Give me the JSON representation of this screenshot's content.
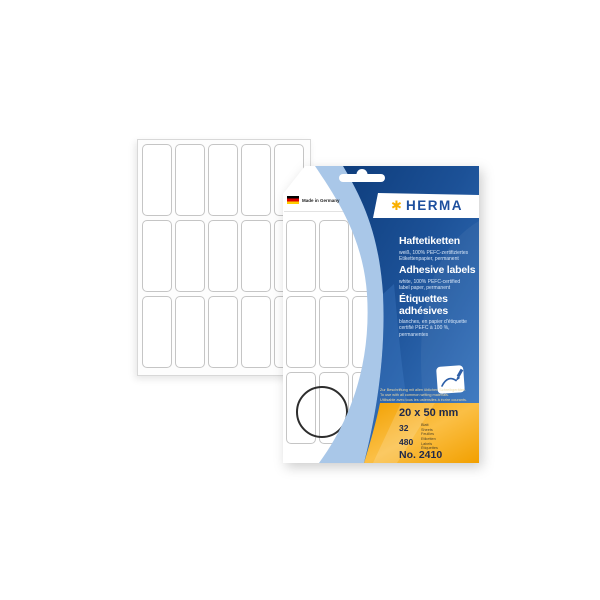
{
  "package": {
    "brand": "HERMA",
    "made_in": "Made in Germany",
    "icons": {
      "brand_star": "✱"
    },
    "titles": {
      "de": {
        "heading": "Haftetiketten",
        "sub1": "weiß, 100% PEFC-zertifiziertes",
        "sub2": "Etikettenpapier, permanent"
      },
      "en": {
        "heading": "Adhesive labels",
        "sub1": "white, 100% PEFC-certified",
        "sub2": "label paper, permanent"
      },
      "fr": {
        "heading1": "Étiquettes",
        "heading2": "adhésives",
        "sub1": "blanches, en papier d'étiquette",
        "sub2": "certifié PEFC à 100 %,",
        "sub3": "permanentes"
      }
    },
    "usage_note": {
      "de": "Zur Beschriftung mit allen üblichen Schreibgeräten.",
      "en": "To use with all common writing materials.",
      "fr": "Utilisable avec tous les ustensiles à écrire courants."
    },
    "specs": {
      "size": "20 x 50 mm",
      "sheets_count": "32",
      "sheets_units": [
        "Blatt",
        "Sheets",
        "Feuilles"
      ],
      "labels_count": "480",
      "labels_units": [
        "Etiketten",
        "Labels",
        "Étiquettes"
      ],
      "item_no": "No. 2410"
    },
    "colors": {
      "navy_dark": "#0e3d7c",
      "blue_bright": "#3a78c2",
      "light_blue_band": "#a9c7e8",
      "orange": "#f5a500",
      "herma_blue": "#1d4f9e",
      "herma_orange": "#f9b000"
    }
  },
  "sheets": {
    "back_sheet_grid": {
      "cols": 5,
      "rows": 3
    },
    "window_sheet_grid": {
      "cols": 3,
      "rows": 3
    }
  }
}
